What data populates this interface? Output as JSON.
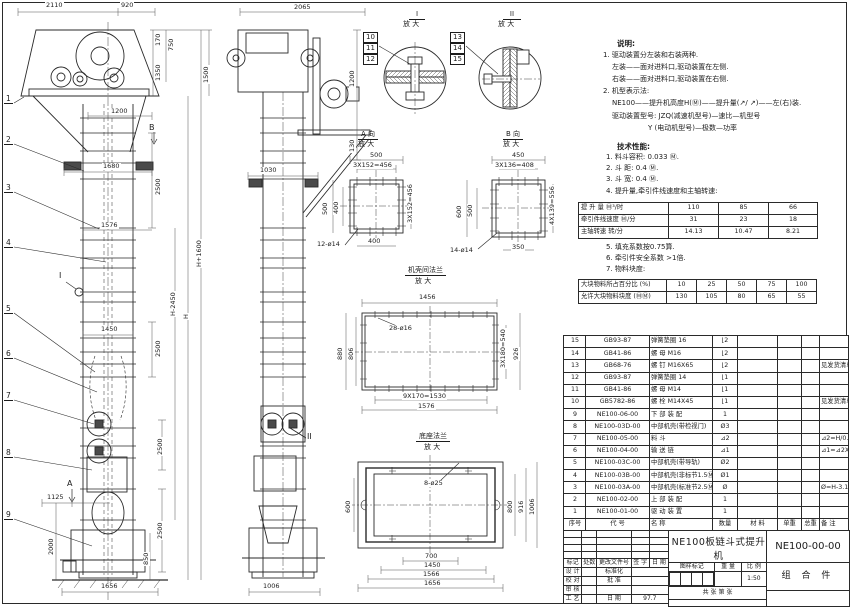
{
  "front_view": {
    "part_refs": [
      "1",
      "2",
      "3",
      "4",
      "5",
      "6",
      "7",
      "8",
      "9"
    ],
    "markers": {
      "a": "A",
      "b": "B",
      "i": "I"
    },
    "dims": {
      "top1": "2110",
      "top2": "920",
      "h170": "170",
      "h750": "750",
      "h1350": "1350",
      "h1500": "1500",
      "w1200": "1200",
      "w1680": "1680",
      "s2500a": "2500",
      "w1576": "1576",
      "hh1600": "H+1600",
      "hh2450": "H-2450",
      "hh": "H",
      "w1450": "1450",
      "s2500b": "2500",
      "s2500c": "2500",
      "s2500d": "2500",
      "w1125": "1125",
      "h2000": "2000",
      "h850": "850",
      "w1656": "1656"
    }
  },
  "side_view": {
    "marker_ii": "II",
    "dims": {
      "top": "2065",
      "r1200": "1200",
      "r130": "130",
      "w1030": "1030",
      "w1006": "1006"
    }
  },
  "detail_1": {
    "title": "I",
    "sub": "放 大",
    "refs": [
      "10",
      "11",
      "12"
    ]
  },
  "detail_2": {
    "title": "II",
    "sub": "放 大",
    "refs": [
      "13",
      "14",
      "15"
    ]
  },
  "detail_a": {
    "title": "A 向",
    "sub": "放 大",
    "dims": {
      "t500": "500",
      "t456": "3X152=456",
      "l500": "500",
      "l400": "400",
      "r456": "3X152=456",
      "b400": "400",
      "holes": "12-ø14"
    }
  },
  "detail_b": {
    "title": "B 向",
    "sub": "放 大",
    "dims": {
      "t450": "450",
      "t408": "3X136=408",
      "l600": "600",
      "l500": "500",
      "r556": "4X139=556",
      "b350": "350",
      "holes": "14-ø14"
    }
  },
  "detail_flange": {
    "title": "机壳间法兰",
    "sub": "放 大",
    "dims": {
      "t1456": "1456",
      "holes": "28-ø16",
      "l880": "880",
      "l806": "806",
      "r540": "3X180=540",
      "r926": "926",
      "b1530": "9X170=1530",
      "b1576": "1576"
    }
  },
  "detail_base": {
    "title": "底座法兰",
    "sub": "放 大",
    "dims": {
      "holes": "8-ø25",
      "l600": "600",
      "r800": "800",
      "r916": "916",
      "r1006": "1006",
      "b700": "700",
      "b1450": "1450",
      "b1566": "1566",
      "b1656": "1656"
    }
  },
  "notes": {
    "heading": "说明:",
    "l1": "1. 驱动装置分左装和右装两种.",
    "l2": "左装——面对进料口,驱动装置在左侧.",
    "l3": "右装——面对进料口,驱动装置在右侧.",
    "l4": "2. 机型表示法:",
    "l5": "NE100——提升机高度H(Ⓜ)——提升量(↗/ ↗)——左(右)装.",
    "l6": "驱动装置型号: JZQ(减速机型号)—速比—机型号",
    "l7": "Y (电动机型号)—极数—功率"
  },
  "specs": {
    "heading": "技术性能:",
    "l1": "1. 料斗容积: 0.033 Ⓜ.",
    "l2": "2. 斗  距: 0.4 Ⓜ.",
    "l3": "3. 斗  宽: 0.4 Ⓜ.",
    "l4": "4. 提升量,牵引件线速度和主轴转速:",
    "l5": "5. 填充系数按0.75算.",
    "l6": "6. 牵引件安全系数 >1倍.",
    "l7": "7. 物料块度:"
  },
  "perf_table": {
    "rows": [
      [
        "提 升 量  Ⓜ³/时",
        "110",
        "85",
        "66"
      ],
      [
        "牵引件线速度 Ⓜ/分",
        "31",
        "23",
        "18"
      ],
      [
        "主轴转速  转/分",
        "14.13",
        "10.47",
        "8.21"
      ]
    ]
  },
  "lump_table": {
    "rows": [
      [
        "大块物料所占百分比 (%)",
        "10",
        "25",
        "50",
        "75",
        "100"
      ],
      [
        "允许大块物料块度 (ⓂⓂ)",
        "130",
        "105",
        "80",
        "65",
        "55"
      ]
    ]
  },
  "parts_table": {
    "rows": [
      [
        "15",
        "GB93-87",
        "弹簧垫圈 16",
        "⌊2",
        "",
        "",
        "",
        ""
      ],
      [
        "14",
        "GB41-86",
        "螺 母  M16",
        "⌊2",
        "",
        "",
        "",
        ""
      ],
      [
        "13",
        "GB68-76",
        "螺 钉  M16X65",
        "⌊2",
        "",
        "",
        "",
        "见发货清单"
      ],
      [
        "12",
        "GB93-87",
        "弹簧垫圈 14",
        "⌊1",
        "",
        "",
        "",
        ""
      ],
      [
        "11",
        "GB41-86",
        "螺 母  M14",
        "⌊1",
        "",
        "",
        "",
        ""
      ],
      [
        "10",
        "GB5782-86",
        "螺 栓  M14X45",
        "⌊1",
        "",
        "",
        "",
        "见发货清单"
      ],
      [
        "9",
        "NE100-06-00",
        "下 部 装 配",
        "1",
        "",
        "",
        "",
        ""
      ],
      [
        "8",
        "NE100-03D-00",
        "中部机壳(带检视门)",
        "Ø3",
        "",
        "",
        "",
        ""
      ],
      [
        "7",
        "NE100-05-00",
        "料  斗",
        "⊿2",
        "",
        "",
        "",
        "⊿2=H/0.2+5.75"
      ],
      [
        "6",
        "NE100-04-00",
        "输 送 链",
        "⊿1",
        "",
        "",
        "",
        "⊿1=⊿2X4"
      ],
      [
        "5",
        "NE100-03C-00",
        "中部机壳(带导轨)",
        "Ø2",
        "",
        "",
        "",
        ""
      ],
      [
        "4",
        "NE100-03B-00",
        "中部机壳(非标节1.5Ⓜ及1Ⓜ)",
        "Ø1",
        "",
        "",
        "",
        ""
      ],
      [
        "3",
        "NE100-03A-00",
        "中部机壳(标准节2.5Ⓜ)",
        "Ø",
        "",
        "",
        "",
        "Ø=H-3.15/2.5"
      ],
      [
        "2",
        "NE100-02-00",
        "上 部 装 配",
        "1",
        "",
        "",
        "",
        ""
      ],
      [
        "1",
        "NE100-01-00",
        "驱 动 装 置",
        "1",
        "",
        "",
        "",
        ""
      ],
      [
        "序号",
        "代  号",
        "名    称",
        "数量",
        "材  料",
        "单重",
        "总重",
        "备 注"
      ]
    ]
  },
  "title_block": {
    "rev_headers": [
      "标记",
      "处数",
      "更改文件号",
      "签 字",
      "日 期"
    ],
    "design": "设 计",
    "standard": "标准化",
    "check": "校 对",
    "approve": "批 准",
    "review": "审 核",
    "craft": "工 艺",
    "date_label": "日 期",
    "date_value": "97.7",
    "title1": "NE100板链斗式提升机",
    "title2": "总  装  图",
    "stamp1": "图样标记",
    "stamp2": "重 量",
    "stamp3": "比 例",
    "scale": "1:50",
    "sheets": "共   张  第   张",
    "drawing_no": "NE100-00-00",
    "category": "组 合 件"
  }
}
